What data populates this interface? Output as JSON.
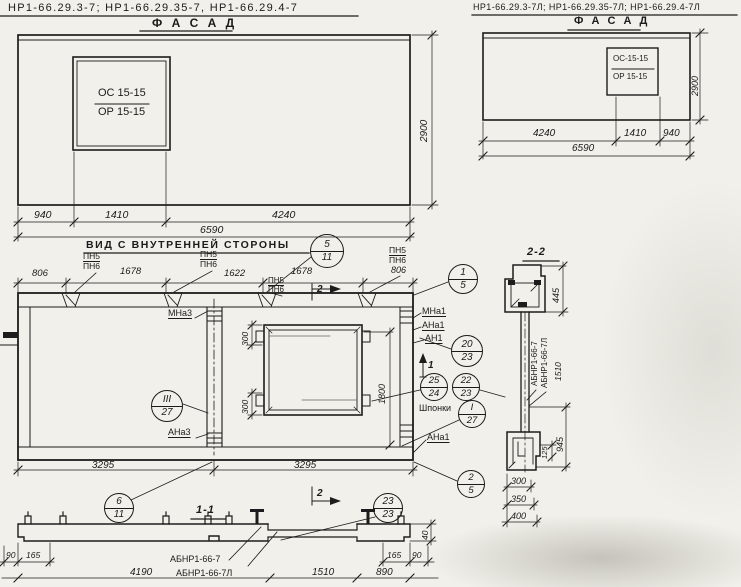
{
  "left_facade": {
    "header": "НР1-66.29.3-7;  НР1-66.29.35-7,  НР1-66.29.4-7",
    "title": "Ф А С А Д",
    "window_mark_top": "ОС 15-15",
    "window_mark_bottom": "ОР 15-15",
    "dim_940": "940",
    "dim_1410": "1410",
    "dim_4240": "4240",
    "dim_total": "6590",
    "dim_height": "2900"
  },
  "right_facade": {
    "header": "НР1-66.29.3-7Л; НР1-66.29.35-7Л; НР1-66.29.4-7Л",
    "title": "Ф А С А Д",
    "window_mark_top": "ОС-15-15",
    "window_mark_bottom": "ОР 15-15",
    "dim_4240": "4240",
    "dim_1410": "1410",
    "dim_940": "940",
    "dim_total": "6590",
    "dim_height": "2900"
  },
  "inner_view": {
    "title": "ВИД С ВНУТРЕННЕЙ СТОРОНЫ",
    "dim_806_left": "806",
    "dim_1678_left": "1678",
    "dim_1622": "1622",
    "dim_1678_right": "1678",
    "dim_806_right": "806",
    "pn5": "ПН5",
    "pn6": "ПН6",
    "section2_label": "2",
    "section1_label": "1",
    "mna3": "МНа3",
    "ana3": "АНа3",
    "mna1": "МНа1",
    "ana1": "АНа1",
    "an1": "АН1",
    "ana1_bottom": "АНа1",
    "shponki": "Шпонки",
    "dim_300_top": "300",
    "dim_300_bottom": "300",
    "dim_1800": "1800",
    "dim_3295_left": "3295",
    "dim_3295_right": "3295"
  },
  "callouts": {
    "c5_11": {
      "top": "5",
      "bottom": "11"
    },
    "c1_5": {
      "top": "1",
      "bottom": "5"
    },
    "c20_23": {
      "top": "20",
      "bottom": "23"
    },
    "c25_24": {
      "top": "25",
      "bottom": "24"
    },
    "c22_23": {
      "top": "22",
      "bottom": "23"
    },
    "cI_27": {
      "top": "I",
      "bottom": "27"
    },
    "cIII_27": {
      "top": "III",
      "bottom": "27"
    },
    "c2_5": {
      "top": "2",
      "bottom": "5"
    },
    "c6_11": {
      "top": "6",
      "bottom": "11"
    },
    "c23_23": {
      "top": "23",
      "bottom": "23"
    }
  },
  "section_2_2": {
    "title": "2-2",
    "dim_445": "445",
    "label_abnr": "АБНР1-66-7",
    "label_abnr_l": "АБНР1-66-7Л",
    "dim_1510": "1510",
    "dim_945": "945",
    "dim_125": "125",
    "dim_300": "300",
    "dim_350": "350",
    "dim_400": "400"
  },
  "section_1_1": {
    "title": "1-1",
    "label_abnr": "АБНР1-66-7",
    "label_abnr_l": "АБНР1-66-7Л",
    "dim_90_left": "90",
    "dim_165_left": "165",
    "dim_4190": "4190",
    "dim_1510": "1510",
    "dim_890": "890",
    "dim_165_right": "165",
    "dim_90_right": "90",
    "dim_40": "40"
  }
}
